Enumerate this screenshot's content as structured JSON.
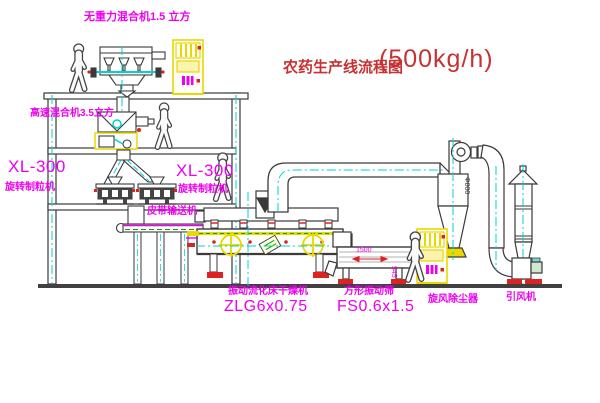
{
  "title": {
    "zh": "农药生产线流程图",
    "capacity": "(500kg/h)"
  },
  "labels": {
    "mixer_top": "无重力混合机1.5 立方",
    "mixer_2f": "高速混合机3.5立方",
    "granulator_left_model": "XL-300",
    "granulator_left_name": "旋转制粒机",
    "granulator_mid_model": "XL-300",
    "granulator_mid_name": "旋转制粒机",
    "belt_conveyor": "皮带输送机",
    "dryer_name": "振动流化床干燥机",
    "dryer_model": "ZLG6x0.75",
    "screen_name": "方形振动筛",
    "screen_model": "FS0.6x1.5",
    "cyclone": "旋风除尘器",
    "fan": "引风机"
  },
  "dimensions": {
    "screen_width": "1500",
    "screen_height": "545",
    "cyclone_dia": "Φ800"
  },
  "colors": {
    "label_magenta": "#ee00ee",
    "title_red": "#c63232",
    "accent_red": "#dd2222",
    "highlight_yellow": "#e8d800",
    "centerline_cyan": "#00d2d2",
    "detail_green": "#00a800",
    "line_dark": "#3a3a3a",
    "background": "#ffffff"
  }
}
